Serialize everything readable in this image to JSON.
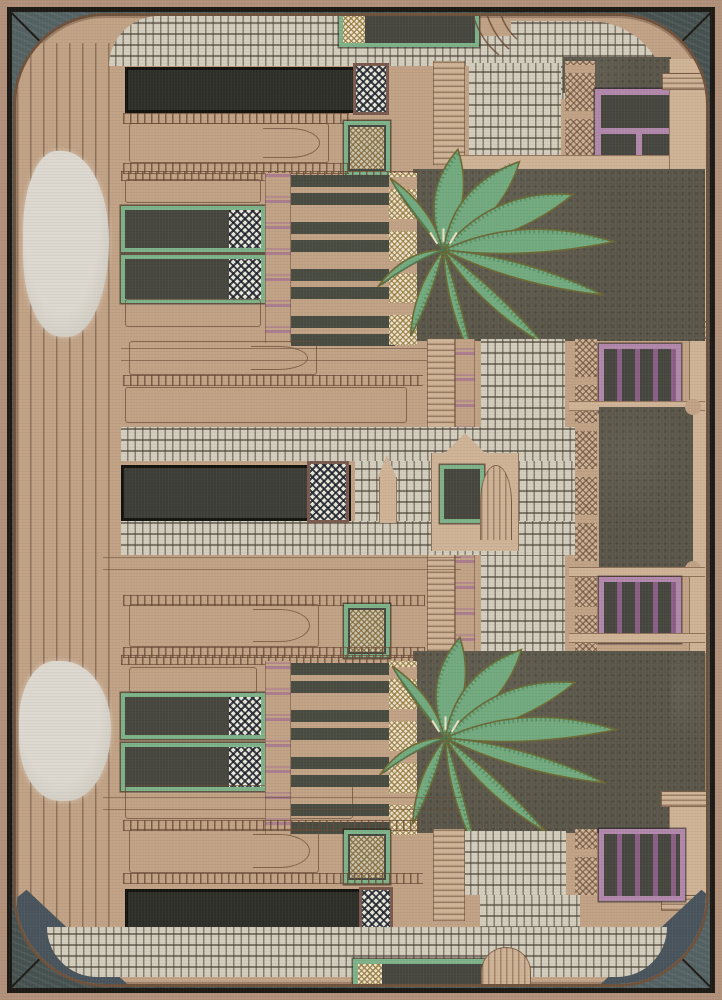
{
  "meta": {
    "domain": "product photograph",
    "subject": "rectangular hand-tufted area rug, viewed flat from above",
    "motif": "Indo-Saracenic palace facade with palm trees, jharokha windows, stairways, balustrades and white mosaic courtyards inside a rounded-corner frame"
  },
  "rug": {
    "inventory": {
      "palm_trees": 2,
      "purple_jharokha_windows": 4,
      "green_framed_windows_left_block": 4,
      "green_lattice_windows": 3,
      "green_banner_windows_top_bottom": 2,
      "dark_architrave_bars": 3,
      "white_mosaic_panels": 6,
      "cobblestone_arcs": 2,
      "stair_bands": 1,
      "silver_wool_patches": 2,
      "corner_diagonal_ties": 4,
      "balustrade_slat_groups": 8
    },
    "palette": {
      "tan_outer": "#b2917a",
      "tan": "#c1a285",
      "tan_light": "#cfb396",
      "line": "#6e523e",
      "ink": "#1d1a15",
      "slate": "#45514f",
      "slate_blue": "#49545c",
      "courtyard": "#5b574a",
      "panel_dark": "#474740",
      "bar_dark": "#2f2f29",
      "mosaic_bg": "#d3cdbd",
      "silver": "#d7d4cb",
      "green_frame": "#7eb289",
      "palm_green": "#73aa7f",
      "palm_dark": "#47724f",
      "purple": "#b188ab",
      "purple_deep": "#8b5f85",
      "gold": "#a88e58"
    }
  }
}
